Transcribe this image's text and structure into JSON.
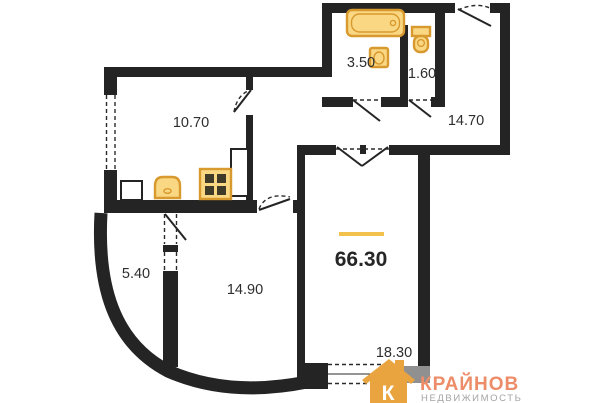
{
  "floorplan": {
    "total_area_label": "66.30",
    "rooms": {
      "kitchen": "10.70",
      "bathroom": "3.50",
      "wc": "1.60",
      "hallway": "14.70",
      "balcony": "5.40",
      "bedroom": "14.90",
      "living_room": "18.30"
    }
  },
  "logo": {
    "monogram": "К",
    "brand": "КРАЙНОВ",
    "subtitle": "НЕДВИЖИМОСТЬ"
  },
  "colors": {
    "wall": "#242424",
    "fixture_fill": "#FAD883",
    "fixture_stroke": "#D8992F",
    "total_underline": "#F2C14E",
    "brand_orange": "#EC8C68",
    "brand_grey": "#A3A3A3"
  }
}
